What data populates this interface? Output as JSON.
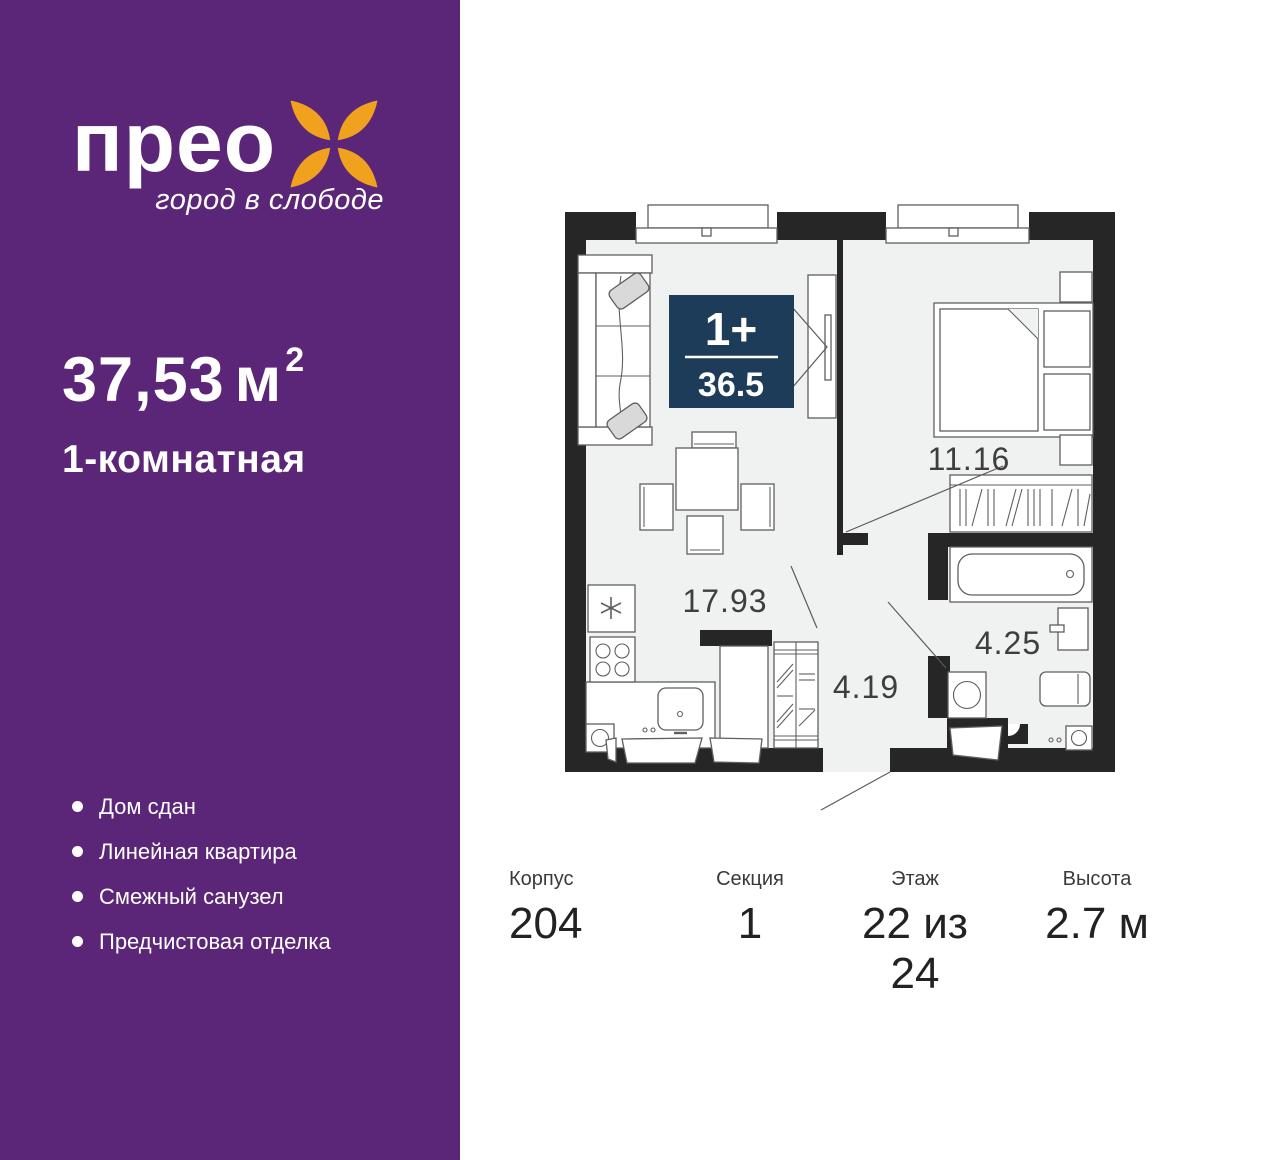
{
  "colors": {
    "purple": "#5b2677",
    "orange": "#f0a11d",
    "navy": "#1d3c59",
    "wall": "#262626",
    "floor": "#f0f2f2"
  },
  "sidebar": {
    "brand": {
      "wordmark": "прео",
      "tagline": "город в слободе",
      "flower_icon": "four-petal-flower-icon"
    },
    "area": {
      "value": "37,53",
      "unit": "м",
      "sup": "2"
    },
    "rooms_label": "1-комнатная",
    "features": [
      {
        "label": "Дом сдан"
      },
      {
        "label": "Линейная квартира"
      },
      {
        "label": "Смежный санузел"
      },
      {
        "label": "Предчистовая отделка"
      }
    ]
  },
  "plan": {
    "badge": {
      "rooms": "1+",
      "area": "36.5"
    },
    "labels": {
      "kitchen_living": "17.93",
      "bedroom": "11.16",
      "bathroom": "4.25",
      "hallway": "4.19"
    },
    "icons": {
      "fridge_marker": "asterisk-icon"
    }
  },
  "stats": [
    {
      "label": "Корпус",
      "value": "204"
    },
    {
      "label": "Секция",
      "value": "1"
    },
    {
      "label": "Этаж",
      "value": "22 из 24"
    },
    {
      "label": "Высота",
      "value": "2.7 м"
    }
  ]
}
